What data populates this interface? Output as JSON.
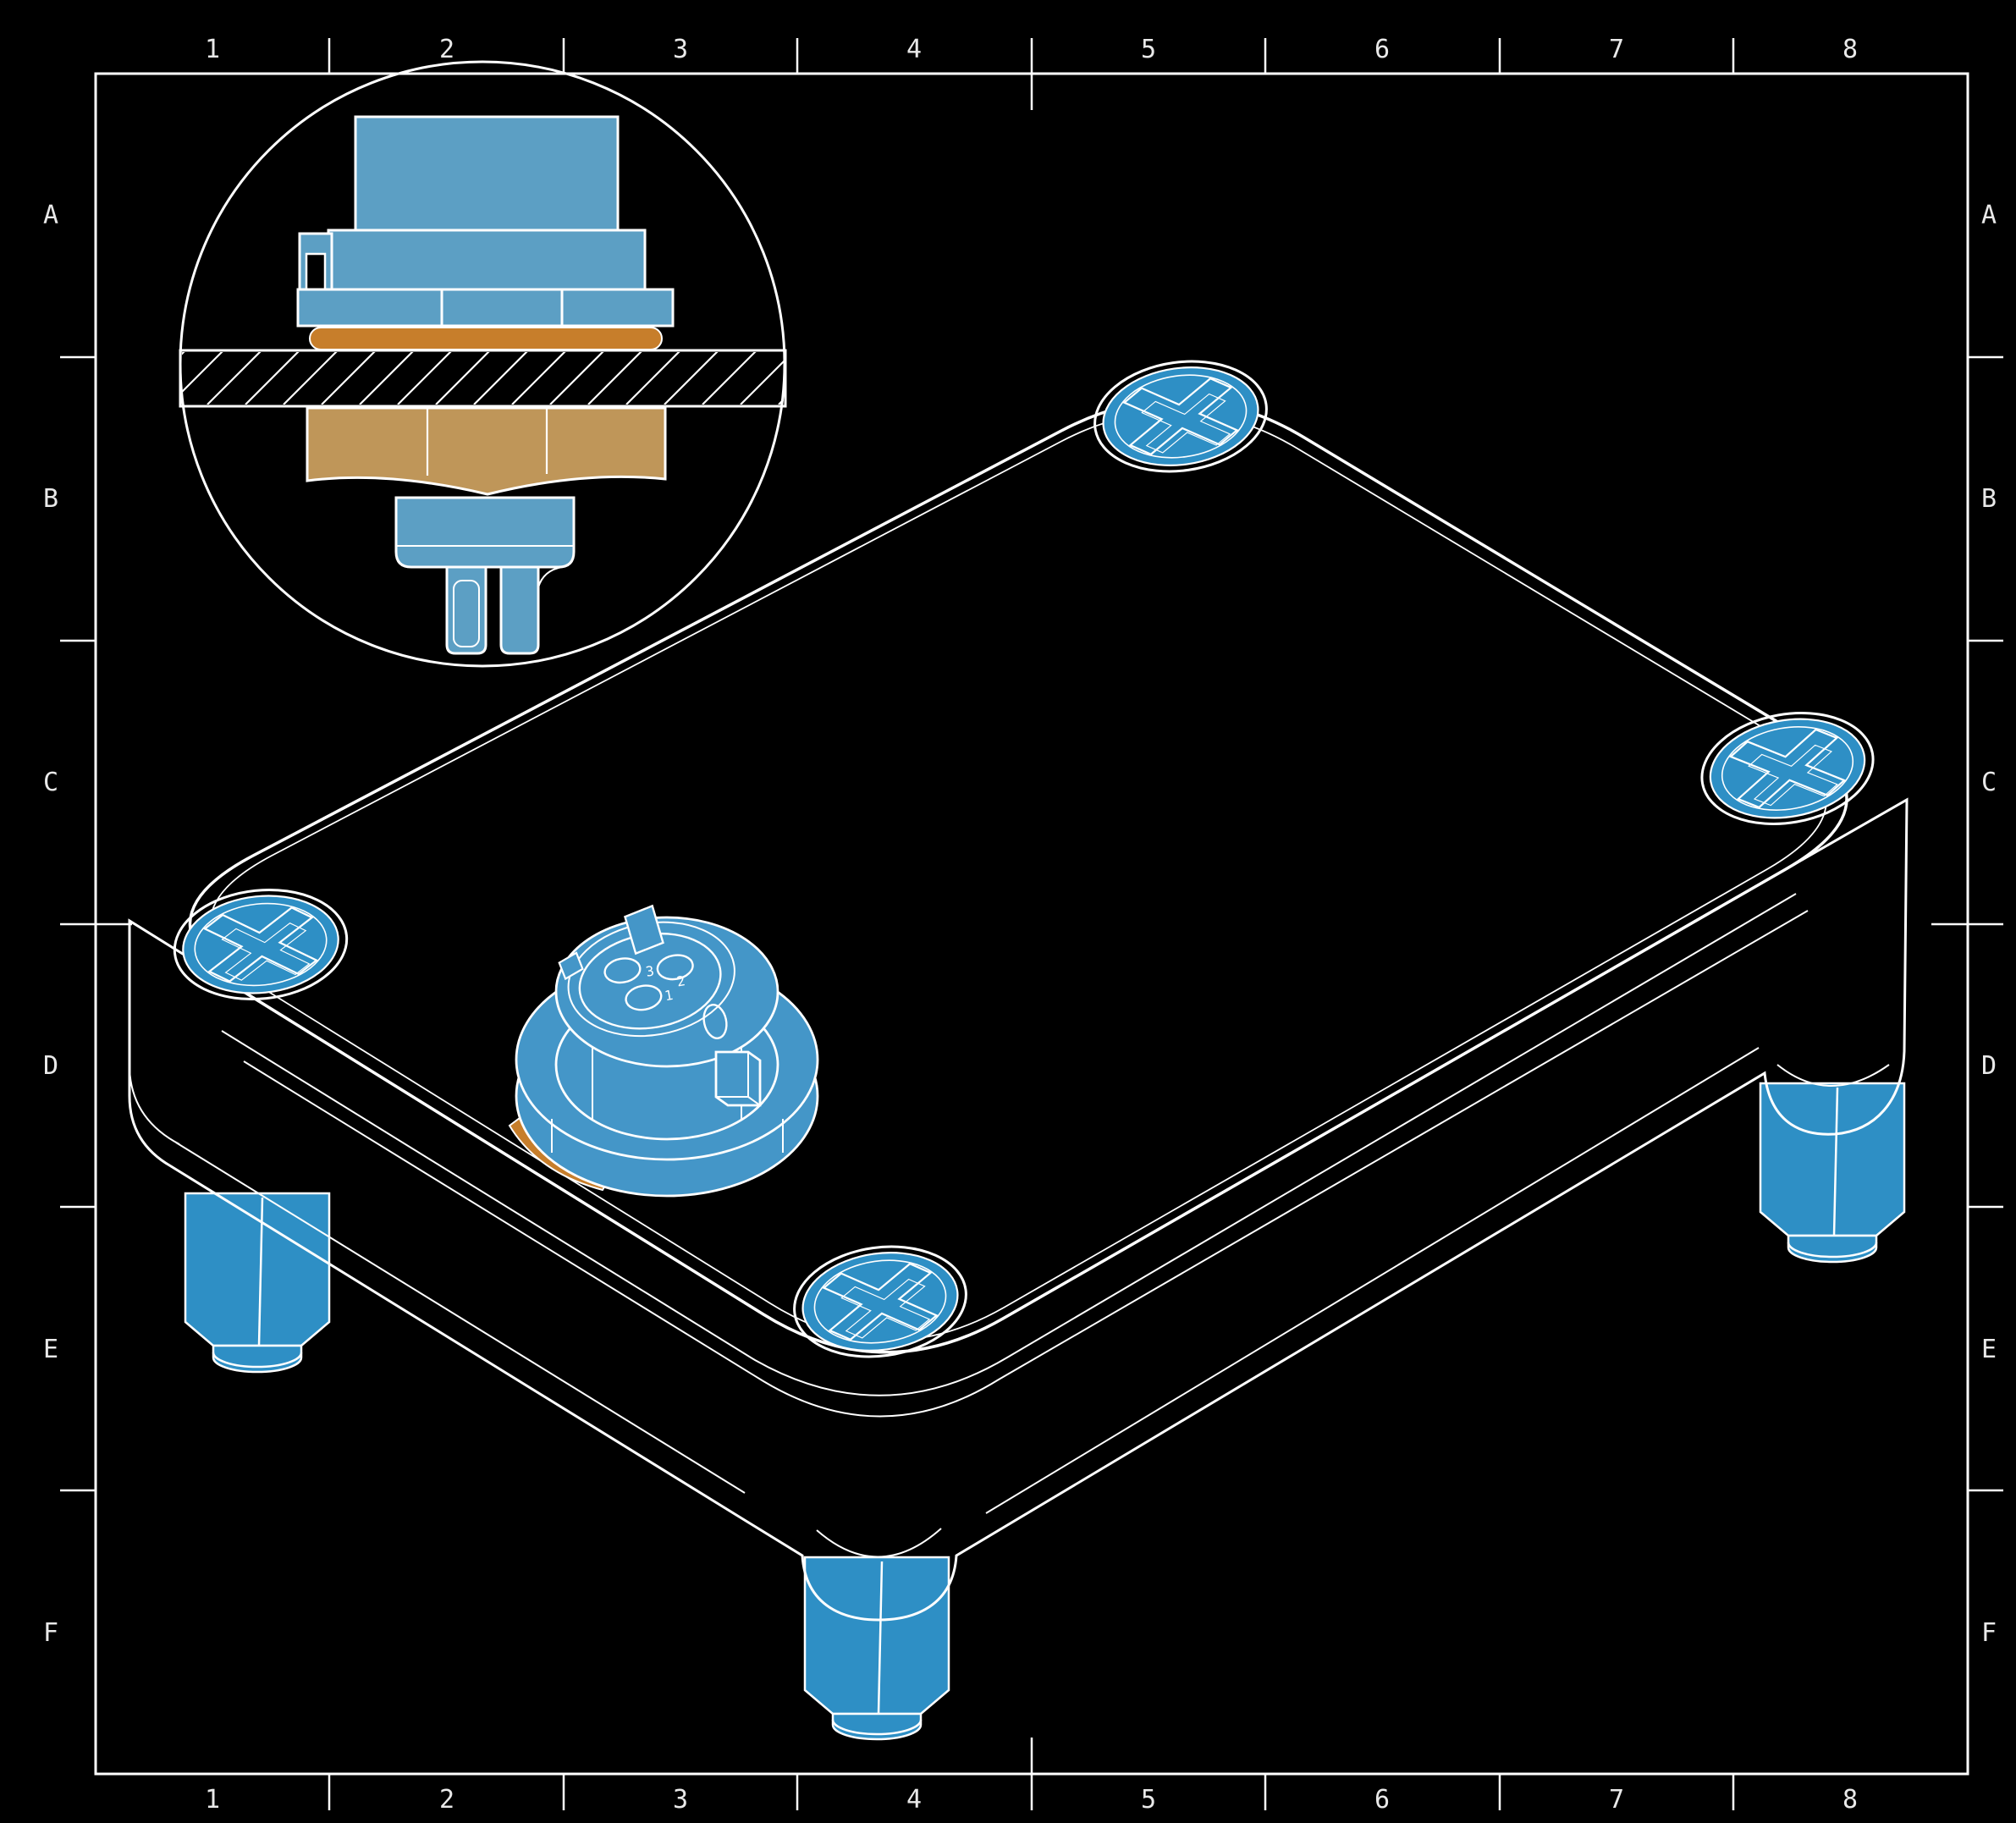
{
  "drawing": {
    "grid": {
      "columns": [
        "1",
        "2",
        "3",
        "4",
        "5",
        "6",
        "7",
        "8"
      ],
      "rows": [
        "A",
        "B",
        "C",
        "D",
        "E",
        "F"
      ]
    },
    "colors": {
      "background": "#000000",
      "line": "#ffffff",
      "grid_text": "#e9e9e9",
      "part_blue": "#2e8fc5",
      "connector_blue": "#4496c8",
      "section_blue": "#5c9fc4",
      "nut_tan": "#bf9659",
      "gasket_orange": "#c77e2b"
    },
    "connector_face": {
      "pin_labels": [
        "1",
        "2",
        "3"
      ]
    }
  }
}
